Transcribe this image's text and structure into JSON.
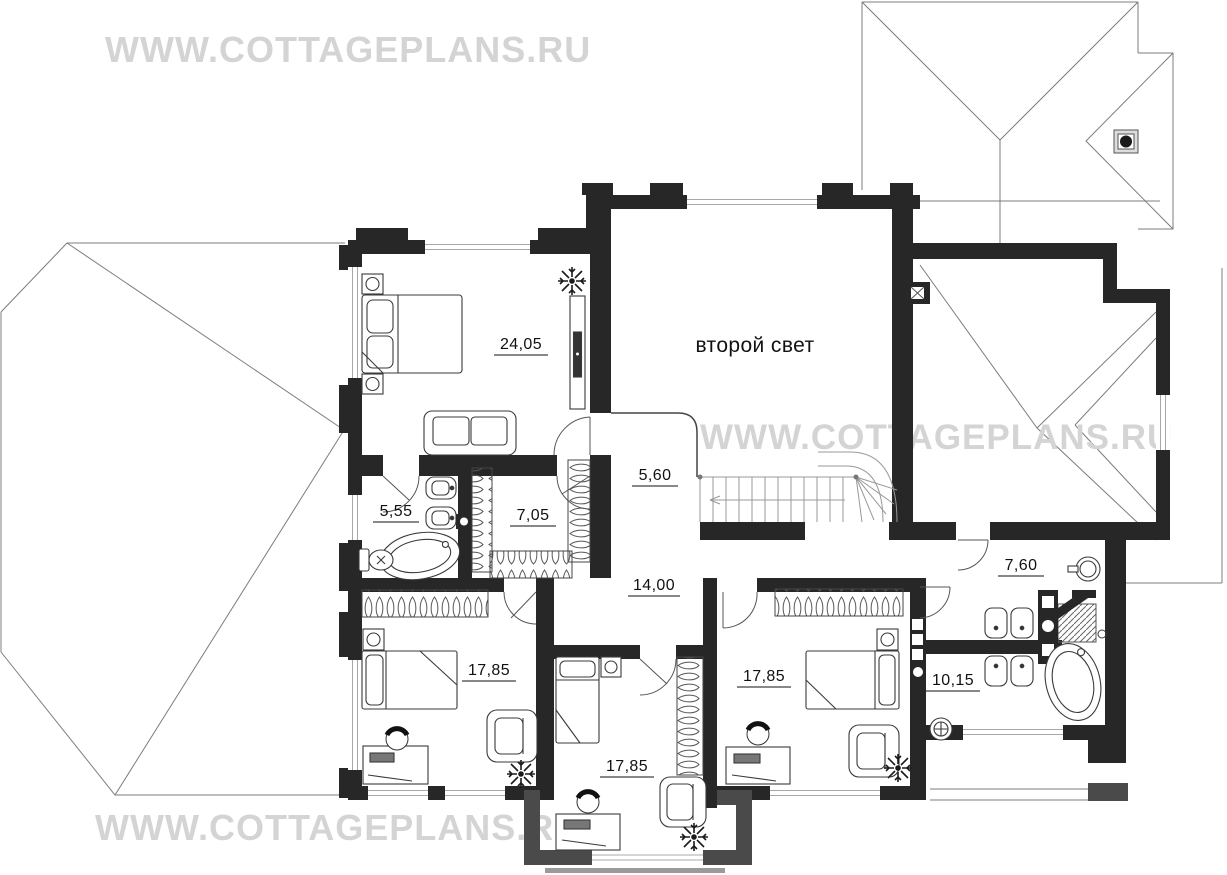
{
  "watermark": {
    "text": "WWW.COTTAGEPLANS.RU"
  },
  "plan": {
    "floor_note": "второй свет",
    "rooms": [
      {
        "name": "master bedroom",
        "area": "24,05"
      },
      {
        "name": "stair landing",
        "area": "5,60"
      },
      {
        "name": "master bathroom",
        "area": "5,55"
      },
      {
        "name": "walk-in closet",
        "area": "7,05"
      },
      {
        "name": "hall",
        "area": "14,00"
      },
      {
        "name": "bedroom left",
        "area": "17,85"
      },
      {
        "name": "bedroom middle",
        "area": "17,85"
      },
      {
        "name": "bedroom right",
        "area": "17,85"
      },
      {
        "name": "dressing room",
        "area": "7,60"
      },
      {
        "name": "bathroom",
        "area": "10,15"
      }
    ]
  },
  "colors": {
    "wall": "#272727",
    "secondary_wall": "#4a4a4a",
    "roof_line": "#7c7c7c",
    "watermark": "#d4d4d4",
    "label": "#111111"
  }
}
